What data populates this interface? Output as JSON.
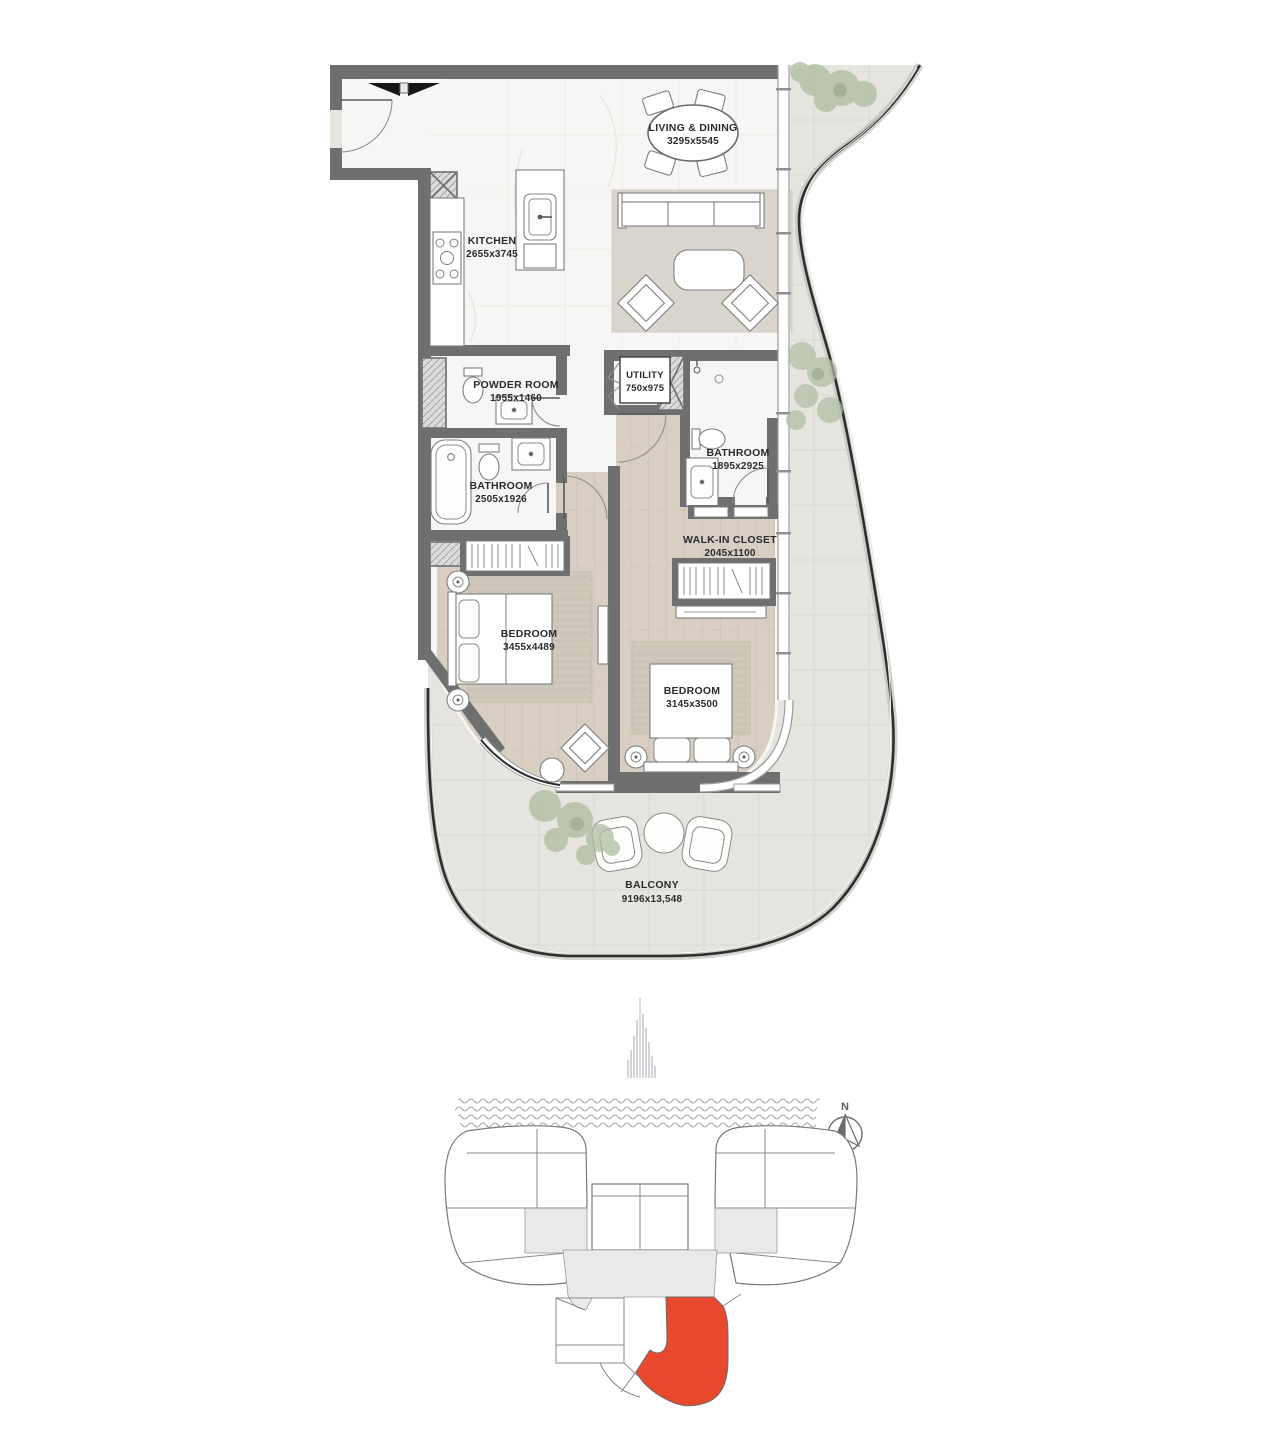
{
  "floor_plan": {
    "rooms": {
      "living_dining": {
        "label": "LIVING & DINING",
        "dims": "3295x5545"
      },
      "kitchen": {
        "label": "KITCHEN",
        "dims": "2655x3745"
      },
      "powder_room": {
        "label": "POWDER ROOM",
        "dims": "1955x1460"
      },
      "utility": {
        "label": "UTILITY",
        "dims": "750x975"
      },
      "bathroom_main": {
        "label": "BATHROOM",
        "dims": "2505x1926"
      },
      "bathroom_second": {
        "label": "BATHROOM",
        "dims": "1895x2925"
      },
      "walk_in_closet": {
        "label": "WALK-IN CLOSET",
        "dims": "2045x1100"
      },
      "bedroom_primary": {
        "label": "BEDROOM",
        "dims": "3455x4489"
      },
      "bedroom_second": {
        "label": "BEDROOM",
        "dims": "3145x3500"
      },
      "balcony": {
        "label": "BALCONY",
        "dims": "9196x13,548"
      }
    },
    "colors": {
      "wall": "#6F6F6F",
      "marble_floor": "#F7F6F4",
      "wood_floor": "#D8CEC2",
      "balcony_floor": "#E6E4DF",
      "greenery": "#AFBDA0",
      "rug": "#CFC7B9"
    }
  },
  "key_plan": {
    "north_label": "N",
    "unit_highlight_color": "#E8482C",
    "water_icon": "waves",
    "landmark_icon": "burj-khalifa-silhouette"
  }
}
